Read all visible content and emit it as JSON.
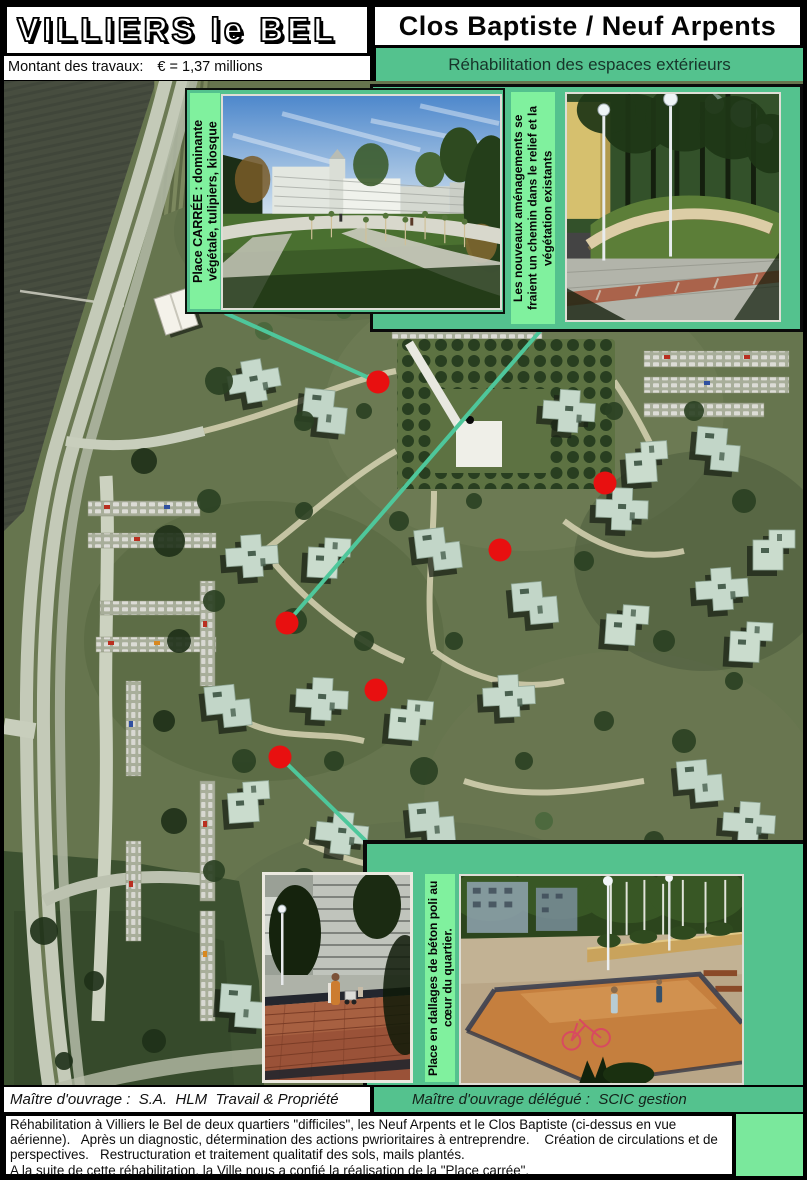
{
  "header": {
    "city_title": "VILLIERS le BEL",
    "montant_label": "Montant des travaux:",
    "montant_value": "€ = 1,37 millions",
    "project_title": "Clos Baptiste / Neuf Arpents",
    "subtitle": "Réhabilitation des espaces extérieurs"
  },
  "insets": {
    "place_carree_caption": "Place CARRÉE : dominante végétale, tulipiers, kiosque",
    "chemin_caption": "Les nouveaux aménagements se fraient un chemin dans le relief et la végétation existants",
    "dallages_caption": "Place en dallages de béton poli au cœur du quartier."
  },
  "map": {
    "marker_color": "#e81010",
    "line_color": "#4ec79b",
    "markers": [
      {
        "x": 378,
        "y": 382
      },
      {
        "x": 605,
        "y": 483
      },
      {
        "x": 500,
        "y": 550
      },
      {
        "x": 287,
        "y": 623
      },
      {
        "x": 376,
        "y": 690
      },
      {
        "x": 280,
        "y": 757
      }
    ],
    "lines": [
      {
        "x1": 225,
        "y1": 313,
        "x2": 378,
        "y2": 382
      },
      {
        "x1": 541,
        "y1": 330,
        "x2": 287,
        "y2": 623
      },
      {
        "x1": 280,
        "y1": 757,
        "x2": 368,
        "y2": 843
      }
    ]
  },
  "footer": {
    "maitre_ouvrage": "Maître d'ouvrage :  S.A.  HLM  Travail & Propriété",
    "maitre_ouvrage_delegue": "Maître d'ouvrage délégué :  SCIC gestion",
    "description_line1": "Réhabilitation à Villiers le Bel de deux quartiers \"difficiles\", les Neuf Arpents et le Clos Baptiste (ci-dessus en vue aérienne).   Après un diagnostic, détermination des actions pwrioritaires à entreprendre.    Création de circulations et de perspectives.   Restructuration et traitement qualitatif des sols, mails plantés.",
    "description_line2": "A la suite de cette réhabilitation, la Ville nous a confié la réalisation de la \"Place carrée\"."
  },
  "colors": {
    "panel_green": "#54c28e",
    "caption_green": "#80f19e",
    "marker_red": "#e81010",
    "connector_green": "#4ec79b"
  }
}
